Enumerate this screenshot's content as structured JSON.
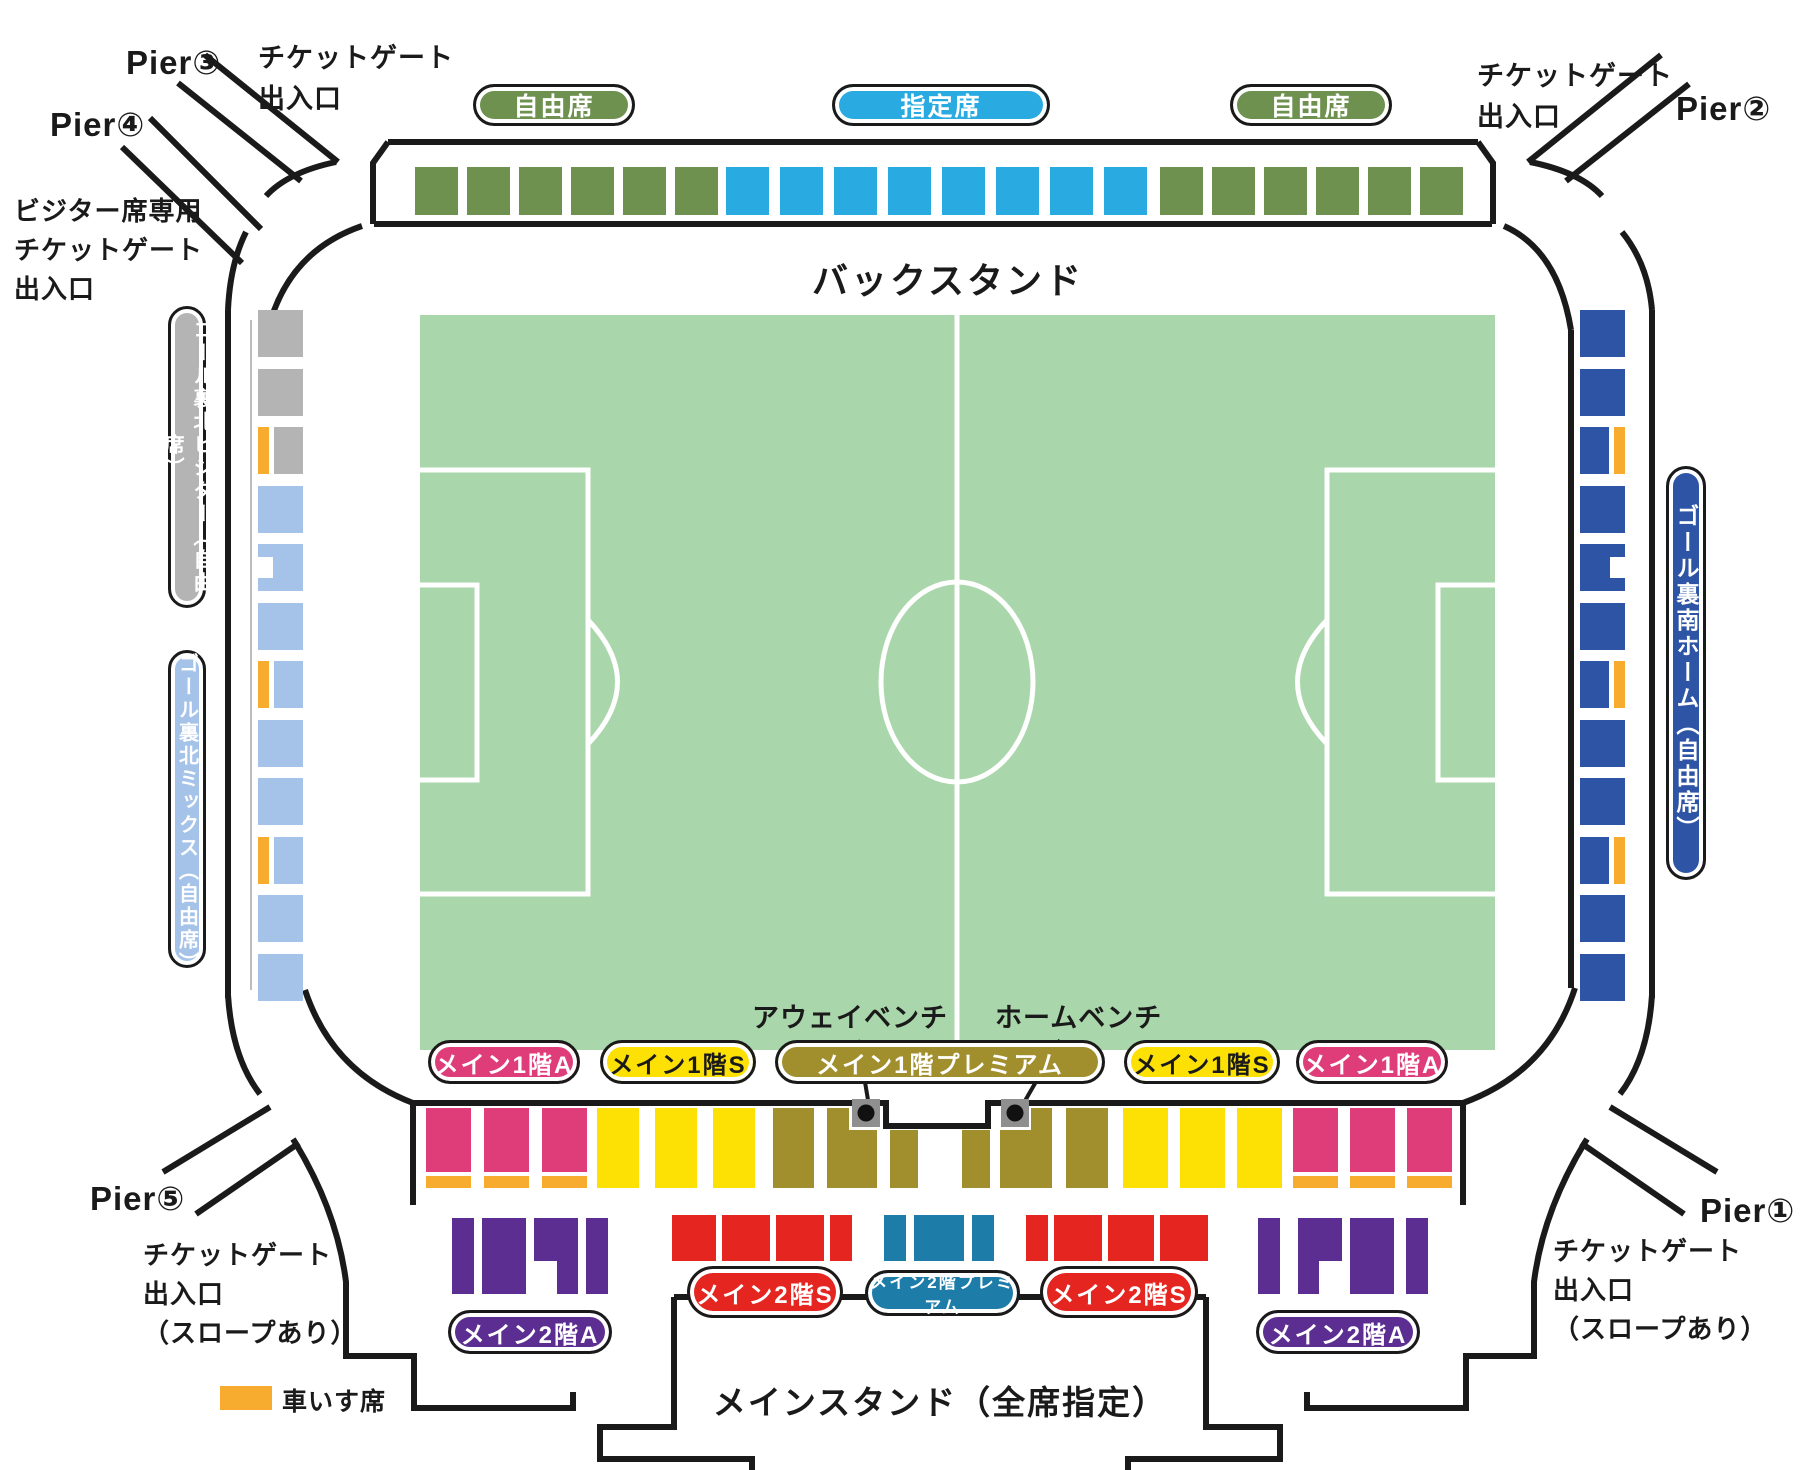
{
  "labels": {
    "back_stand": "バックスタンド",
    "main_stand": "メインスタンド（全席指定）",
    "away_bench": "アウェイベンチ",
    "home_bench": "ホームベンチ",
    "pier1": "Pier①",
    "pier2": "Pier②",
    "pier3": "Pier③",
    "pier4": "Pier④",
    "pier5": "Pier⑤",
    "gate": "チケットゲート\n出入口",
    "gate_slope": "チケットゲート\n出入口\n（スロープあり）",
    "visitor_gate": "ビジター席専用\nチケットゲート\n出入口"
  },
  "sections": [
    {
      "id": "back-free",
      "label": "自由席",
      "color": "green",
      "text": "#ffffff"
    },
    {
      "id": "back-reserved",
      "label": "指定席",
      "color": "sky",
      "text": "#ffffff"
    },
    {
      "id": "goal-north-visitor",
      "label": "ゴール裏北ビジター（自由席）",
      "color": "gray",
      "text": "#ffffff"
    },
    {
      "id": "goal-north-mix",
      "label": "ゴール裏北ミックス（自由席）",
      "color": "lightblue",
      "text": "#ffffff"
    },
    {
      "id": "goal-south-home",
      "label": "ゴール裏南ホーム（自由席）",
      "color": "navy",
      "text": "#ffffff"
    },
    {
      "id": "main1-a",
      "label": "メイン1階A",
      "color": "pink",
      "text": "#ffffff"
    },
    {
      "id": "main1-s",
      "label": "メイン1階S",
      "color": "yellow",
      "text": "#1a1a1a"
    },
    {
      "id": "main1-premium",
      "label": "メイン1階プレミアム",
      "color": "olive",
      "text": "#ffffff"
    },
    {
      "id": "main2-a",
      "label": "メイン2階A",
      "color": "purple",
      "text": "#ffffff"
    },
    {
      "id": "main2-s",
      "label": "メイン2階S",
      "color": "red",
      "text": "#ffffff"
    },
    {
      "id": "main2-premium",
      "label": "メイン2階プレミアム",
      "color": "teal",
      "text": "#ffffff"
    },
    {
      "id": "wheelchair",
      "label": "車いす席",
      "color": "orange",
      "text": "#1a1a1a"
    }
  ],
  "colors": {
    "green": "#6f9150",
    "sky": "#29abe2",
    "field": "#a9d6aa",
    "gray": "#b4b4b5",
    "lightblue": "#a5c3e8",
    "navy": "#2e55a5",
    "orange": "#f7ab2f",
    "pink": "#de3d7a",
    "yellow": "#fde104",
    "olive": "#a18e2c",
    "purple": "#5c2e91",
    "red": "#e52520",
    "teal": "#1e7ca8",
    "line": "#1a1a1a",
    "bench": "#8f8f8f",
    "white": "#ffffff"
  }
}
